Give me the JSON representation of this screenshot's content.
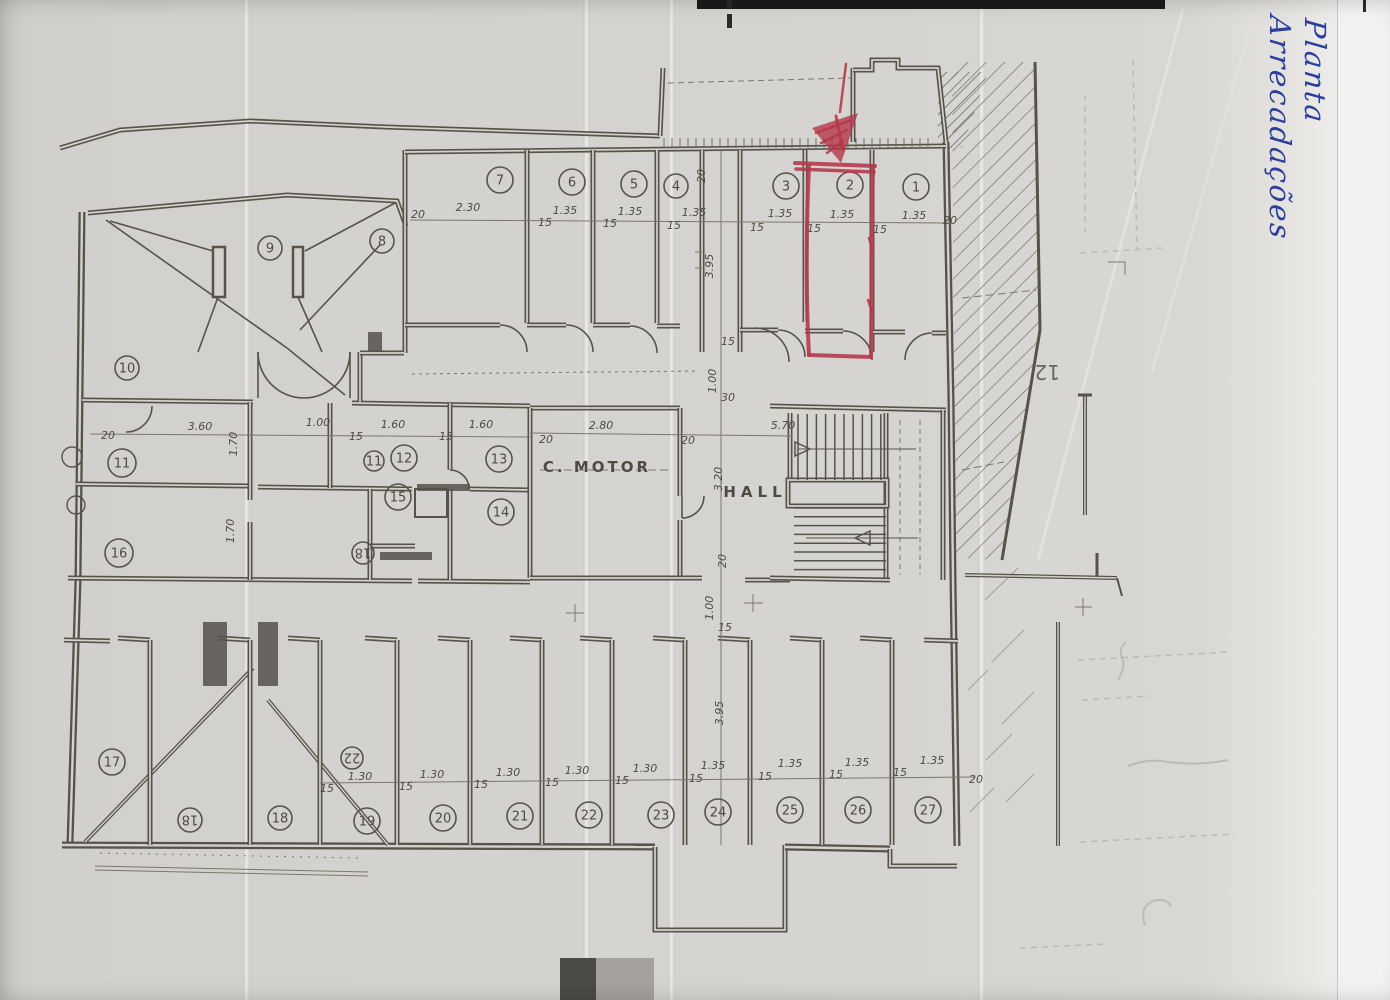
{
  "document": {
    "handwritten_note": {
      "line1": "Planta",
      "line2": "Arrecadações"
    },
    "bleed_through_label": "12"
  },
  "plan": {
    "room_labels": {
      "c_motor": "C. MOTOR",
      "hall": "HALL"
    },
    "marked_unit": "2",
    "units": [
      "7",
      "6",
      "5",
      "4",
      "3",
      "2",
      "1",
      "9",
      "8",
      "10",
      "11",
      "11",
      "12",
      "13",
      "15",
      "14",
      "16",
      "18",
      "17",
      "22",
      "18",
      "18",
      "19",
      "20",
      "21",
      "22",
      "23",
      "24",
      "25",
      "26",
      "27"
    ],
    "dimensions": [
      "20",
      "2.30",
      "15",
      "1.35",
      "15",
      "1.35",
      "15",
      "1.35",
      "20",
      "15",
      "1.35",
      "15",
      "1.35",
      "15",
      "1.35",
      "20",
      "3.95",
      "15",
      "1.00",
      "30",
      "20",
      "3.60",
      "1.70",
      "1.00",
      "15",
      "1.60",
      "15",
      "1.60",
      "20",
      "2.80",
      "20",
      "5.70",
      "1.70",
      "3.20",
      "20",
      "1.00",
      "15",
      "3.95",
      "1.30",
      "1.30",
      "1.30",
      "1.30",
      "1.30",
      "1.35",
      "1.35",
      "1.35",
      "1.35",
      "20",
      "15",
      "15",
      "15",
      "15",
      "15",
      "15",
      "15",
      "15",
      "15"
    ]
  },
  "colors": {
    "red_pen": "#b5374b",
    "blue_ink": "#2b3f9e",
    "plan_line": "#57534c",
    "paper": "#d6d4d0"
  }
}
